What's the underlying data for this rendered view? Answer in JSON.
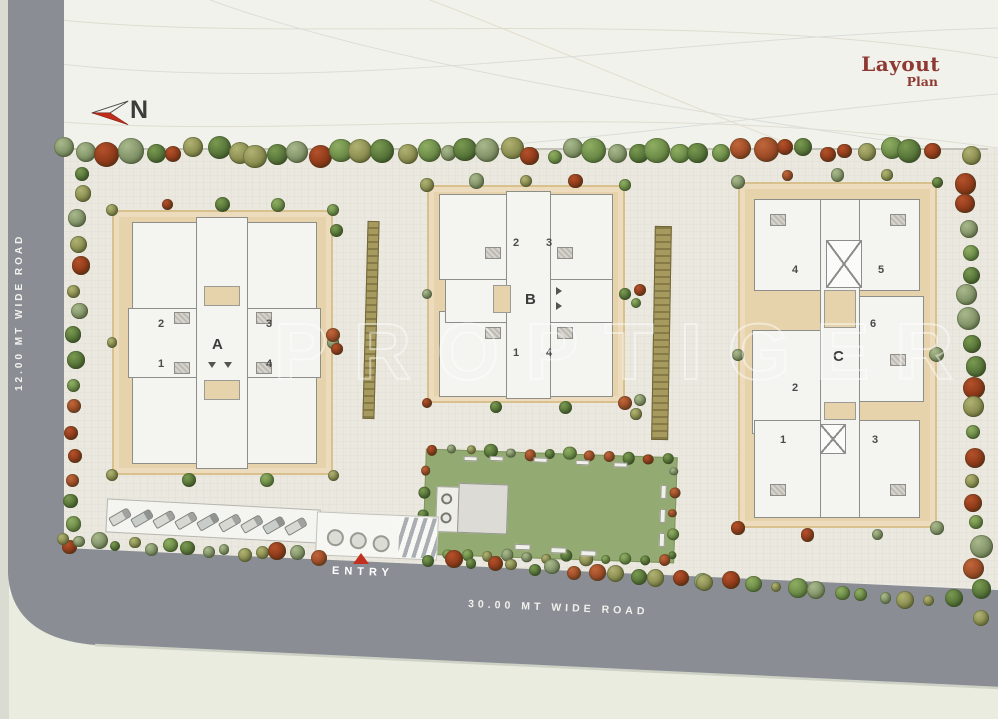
{
  "title": {
    "word1": "Layout",
    "word2": "Plan"
  },
  "compass": {
    "label": "N"
  },
  "roads": {
    "left_label": "12.00 MT WIDE ROAD",
    "bottom_label": "30.00 MT WIDE ROAD"
  },
  "entry": {
    "label": "ENTRY"
  },
  "watermark": {
    "text": "PROPTIGER"
  },
  "buildings": [
    {
      "label": "A",
      "units": {
        "u1": "1",
        "u2": "2",
        "u3": "3",
        "u4": "4"
      }
    },
    {
      "label": "B",
      "units": {
        "u1": "1",
        "u2": "2",
        "u3": "3",
        "u4": "4"
      }
    },
    {
      "label": "C",
      "units": {
        "u1": "1",
        "u2": "2",
        "u3": "3",
        "u4": "4",
        "u5": "5",
        "u6": "6"
      }
    }
  ],
  "colors": {
    "background": "#f2f2ec",
    "road": "#8a8e94",
    "paving": "#ebe8e0",
    "plot_tan": "#e7d3ab",
    "lawn_green": "#93ab72",
    "title_red": "#8e3a33",
    "entry_red": "#c2301f",
    "building_wall": "#8d8d89",
    "tree_palette": [
      [
        "#8fae62",
        "#5c7c3c"
      ],
      [
        "#7a9a50",
        "#47642f"
      ],
      [
        "#b0b272",
        "#7c7f43"
      ],
      [
        "#a9b98c",
        "#72845a"
      ],
      [
        "#c0663a",
        "#8d3f1e"
      ],
      [
        "#b4512b",
        "#7e3012"
      ]
    ]
  }
}
